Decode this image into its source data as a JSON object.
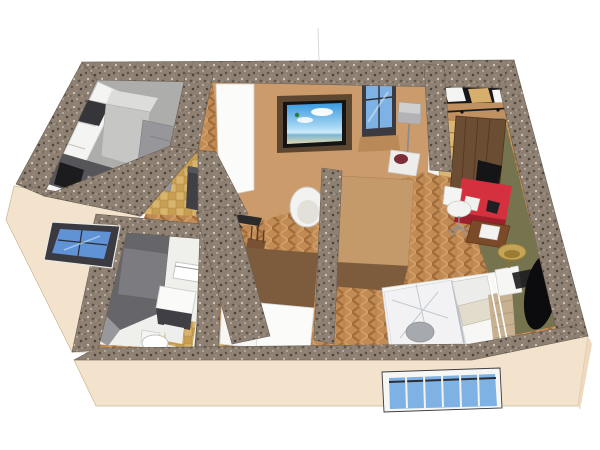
{
  "scene": {
    "kind": "3d-apartment-floorplan-render",
    "rooms": [
      {
        "name": "kitchen",
        "floor": "gray"
      },
      {
        "name": "entry-hall",
        "floor": "tan-checker-tile"
      },
      {
        "name": "living-room",
        "floor": "herringbone-wood"
      },
      {
        "name": "bathroom",
        "floor": "white-and-tan-tile"
      },
      {
        "name": "bedroom",
        "floor": "herringbone-wood-and-olive"
      },
      {
        "name": "closet-nook",
        "floor": "herringbone-wood"
      }
    ],
    "furniture": [
      "white-upper-cabinets",
      "fridge",
      "gray-base-cabinets",
      "dark-countertop-with-sink",
      "black-cooktop",
      "white-interior-door",
      "wall-tv-beach-screen",
      "living-window",
      "floor-lamp",
      "white-tub-chair",
      "white-chair-maroon-pillow",
      "black-side-stool",
      "wooden-chair",
      "small-black-desk",
      "shoe-cabinet",
      "black-shelf-closet",
      "sliding-barn-door",
      "ladder-shelf",
      "red-desk",
      "black-monitor",
      "white-office-chair",
      "brown-side-table",
      "bed-marble-duvet",
      "pillows",
      "tan-blanket",
      "white-nightstand",
      "brass-table-lamp",
      "black-oval-rug",
      "shower-enclosure",
      "vanity-sink",
      "toilet",
      "towel-rack",
      "glass-partition",
      "white-wardrobe-fronts"
    ],
    "windows": [
      "left-window-dark-frame",
      "living-room-window",
      "bottom-window-white-mullions"
    ]
  },
  "colors": {
    "background": "#ffffff",
    "wall_speckle_base": "#8e8174",
    "exterior_cream": "#f3e3cd",
    "exterior_cream_shade": "#eed9bf",
    "interior_tan_wall": "#cb9b6c",
    "hall_brown": "#7c5c3d",
    "wardrobe_top_tan": "#c49a6a",
    "olive_floor": "#76744f",
    "kitchen_floor": "#adadab",
    "bathroom_floor": "#efefec",
    "shower_gray_dark": "#66666a",
    "shower_gray_light": "#98989c",
    "glass_blue": "#7fb2e4",
    "glass_blue_deep": "#5f93d6",
    "window_frame_dark": "#3a3a40",
    "window_frame_white": "#f6f6f4",
    "tv_wood": "#5e4730",
    "tv_black": "#141414",
    "door_white": "#fbfbfa",
    "barn_door_wood": "#6b4d33",
    "ladder_tan": "#d9b673",
    "closet_black": "#17171a",
    "box_white": "#f4f4f2",
    "box_tan": "#d8ae6c",
    "desk_red": "#d4303e",
    "desk_red_dark": "#9e1f2c",
    "monitor_black": "#151517",
    "chair_white": "#f2f2f0",
    "pillow_maroon": "#7c2e38",
    "bed_white": "#f2f2f4",
    "blanket_tan": "#c8b191",
    "lamp_brass": "#c5a458",
    "rug_black": "#0c0c0e",
    "side_table_brown": "#7b4a28",
    "counter_dark": "#55555a",
    "fridge_gray": "#c6c6c4",
    "cabinet_gray": "#97979b",
    "green_glass": "#2e6b4f"
  }
}
